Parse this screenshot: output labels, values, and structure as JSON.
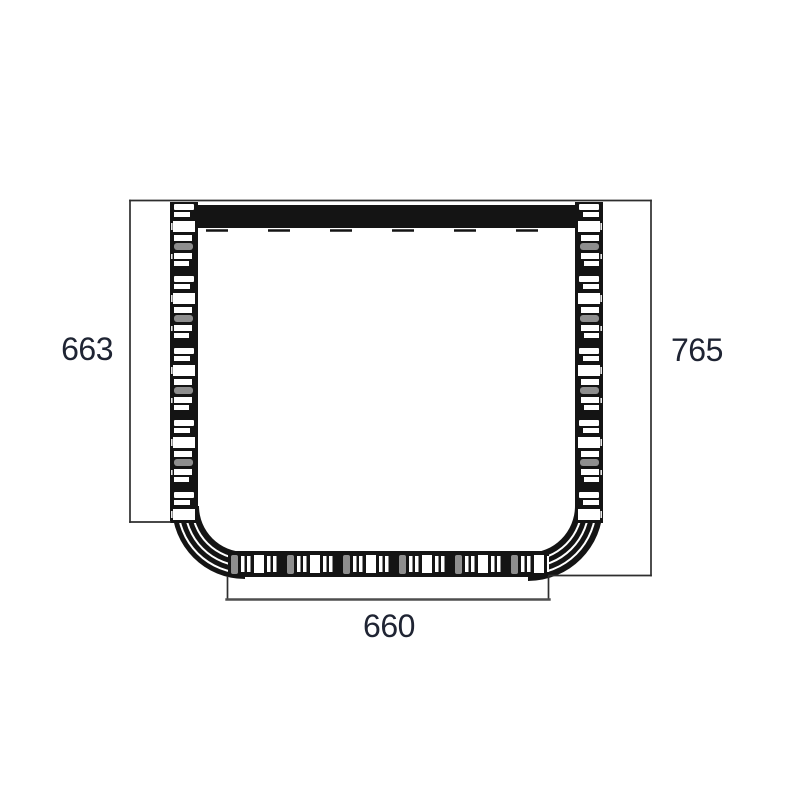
{
  "drawing": {
    "dimension_labels": {
      "left": "663",
      "right": "765",
      "bottom": "660"
    },
    "colors": {
      "background": "#ffffff",
      "line": "#141414",
      "dimension_line": "#2e2e2e",
      "dimension_baseline": "#4f4f4f",
      "label_text": "#1f2433",
      "capsule_gray": "#8e8e8e",
      "slot_white": "#ffffff"
    }
  }
}
